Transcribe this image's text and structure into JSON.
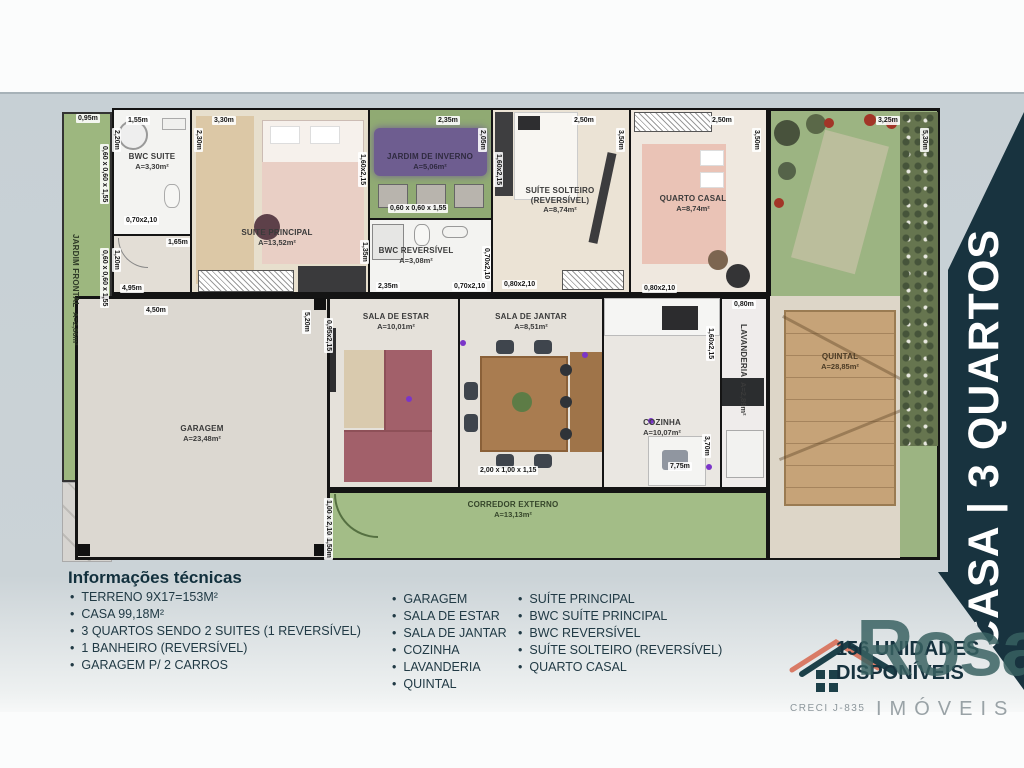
{
  "banner": {
    "title": "CASA | 3 QUARTOS"
  },
  "plan": {
    "rooms": {
      "jardim_frontal": {
        "name": "JARDIM FRONTAL",
        "area": "A=2,86m²"
      },
      "bwc_suite": {
        "name": "BWC SUITE",
        "area": "A=3,30m²"
      },
      "suite_principal": {
        "name": "SUITE PRINCIPAL",
        "area": "A=13,52m²"
      },
      "jardim_inverno": {
        "name": "JARDIM DE INVERNO",
        "area": "A=5,06m²"
      },
      "bwc_reversivel": {
        "name": "BWC REVERSÍVEL",
        "area": "A=3,08m²"
      },
      "suite_solteiro": {
        "name": "SUÍTE SOLTEIRO (REVERSÍVEL)",
        "area": "A=8,74m²"
      },
      "quarto_casal": {
        "name": "QUARTO CASAL",
        "area": "A=8,74m²"
      },
      "garagem": {
        "name": "GARAGEM",
        "area": "A=23,48m²"
      },
      "sala_estar": {
        "name": "SALA DE ESTAR",
        "area": "A=10,01m²"
      },
      "sala_jantar": {
        "name": "SALA DE JANTAR",
        "area": "A=8,51m²"
      },
      "cozinha": {
        "name": "COZINHA",
        "area": "A=10,07m²"
      },
      "lavanderia": {
        "name": "LAVANDERIA",
        "area": "A=2,89m²"
      },
      "quintal": {
        "name": "QUINTAL",
        "area": "A=28,85m²"
      },
      "corredor_externo": {
        "name": "CORREDOR EXTERNO",
        "area": "A=13,13m²"
      }
    },
    "dims": [
      {
        "t": "0,95m",
        "x": 14,
        "y": 14
      },
      {
        "t": "1,55m",
        "x": 64,
        "y": 16
      },
      {
        "t": "2,20m",
        "x": 50,
        "y": 28,
        "v": true
      },
      {
        "t": "3,30m",
        "x": 150,
        "y": 16
      },
      {
        "t": "2,30m",
        "x": 132,
        "y": 28,
        "v": true
      },
      {
        "t": "2,35m",
        "x": 374,
        "y": 16
      },
      {
        "t": "2,05m",
        "x": 416,
        "y": 28,
        "v": true
      },
      {
        "t": "2,50m",
        "x": 510,
        "y": 16
      },
      {
        "t": "3,50m",
        "x": 554,
        "y": 28,
        "v": true
      },
      {
        "t": "2,50m",
        "x": 648,
        "y": 16
      },
      {
        "t": "3,50m",
        "x": 690,
        "y": 28,
        "v": true
      },
      {
        "t": "3,25m",
        "x": 814,
        "y": 16
      },
      {
        "t": "5,30m",
        "x": 858,
        "y": 28,
        "v": true
      },
      {
        "t": "0,60 x 0,60 x 1,55",
        "x": 38,
        "y": 44,
        "v": true
      },
      {
        "t": "0,60 x 0,60 x 1,55",
        "x": 38,
        "y": 148,
        "v": true
      },
      {
        "t": "0,70x2,10",
        "x": 62,
        "y": 116
      },
      {
        "t": "1,65m",
        "x": 104,
        "y": 138
      },
      {
        "t": "1,20m",
        "x": 50,
        "y": 148,
        "v": true
      },
      {
        "t": "4,95m",
        "x": 58,
        "y": 184
      },
      {
        "t": "1,60x2,15",
        "x": 296,
        "y": 52,
        "v": true
      },
      {
        "t": "0,60 x 0,60 x 1,55",
        "x": 326,
        "y": 104
      },
      {
        "t": "1,35m",
        "x": 298,
        "y": 140,
        "v": true
      },
      {
        "t": "2,35m",
        "x": 314,
        "y": 182
      },
      {
        "t": "0,70x2,10",
        "x": 390,
        "y": 182
      },
      {
        "t": "0,70x2,10",
        "x": 420,
        "y": 146,
        "v": true
      },
      {
        "t": "1,60x2,15",
        "x": 432,
        "y": 52,
        "v": true
      },
      {
        "t": "0,80x2,10",
        "x": 440,
        "y": 180
      },
      {
        "t": "0,80x2,10",
        "x": 580,
        "y": 184
      },
      {
        "t": "0,80m",
        "x": 670,
        "y": 200
      },
      {
        "t": "1,60x2,15",
        "x": 644,
        "y": 226,
        "v": true
      },
      {
        "t": "4,50m",
        "x": 82,
        "y": 206
      },
      {
        "t": "5,20m",
        "x": 240,
        "y": 210,
        "v": true
      },
      {
        "t": "0,95x2,15",
        "x": 262,
        "y": 218,
        "v": true
      },
      {
        "t": "2,00 x 1,00 x 1,15",
        "x": 416,
        "y": 366
      },
      {
        "t": "7,75m",
        "x": 606,
        "y": 362
      },
      {
        "t": "3,70m",
        "x": 640,
        "y": 334,
        "v": true
      },
      {
        "t": "1,00 x 2,10",
        "x": 262,
        "y": 398,
        "v": true
      },
      {
        "t": "1,50m",
        "x": 262,
        "y": 436,
        "v": true
      }
    ]
  },
  "info": {
    "heading": "Informações técnicas",
    "col1": [
      "TERRENO 9X17=153M²",
      "CASA 99,18M²",
      "3 QUARTOS SENDO 2 SUITES (1 REVERSÍVEL)",
      "1 BANHEIRO (REVERSÍVEL)",
      "GARAGEM P/ 2 CARROS"
    ],
    "col2": [
      "GARAGEM",
      "SALA DE ESTAR",
      "SALA DE JANTAR",
      "COZINHA",
      "LAVANDERIA",
      "QUINTAL"
    ],
    "col3": [
      "SUÍTE PRINCIPAL",
      "BWC SUÍTE PRINCIPAL",
      "BWC REVERSÍVEL",
      "SUÍTE SOLTEIRO (REVERSÍVEL)",
      "QUARTO CASAL"
    ]
  },
  "footer": {
    "units_line1": "156 UNIDADES",
    "units_line2": "DISPONÍVEIS",
    "creci": "CRECI J-835",
    "brand": "Rosa",
    "brand_sub": "IMÓVEIS"
  },
  "colors": {
    "banner_navy": "#18333f",
    "brand_teal": "#3a6466",
    "accent_salmon": "#d97b66"
  }
}
